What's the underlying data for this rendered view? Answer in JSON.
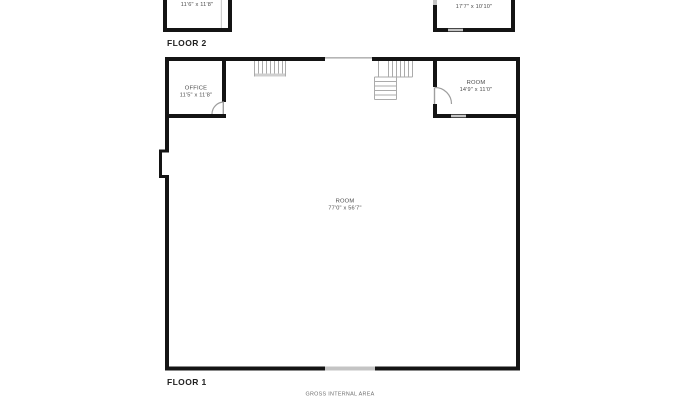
{
  "colors": {
    "background": "#ffffff",
    "wall": "#141414",
    "stair_line": "#ababab",
    "door_arc": "#9e9e9e",
    "window_fill": "#c4c4c4",
    "floor_label_text": "#1f1f1f",
    "dimension_text": "#4a4a4a",
    "footer_text": "#6f6f6f"
  },
  "floor2": {
    "label": "FLOOR 2",
    "left_room": {
      "dims": "11'6\" x 11'8\""
    },
    "right_room": {
      "dims": "17'7\" x 10'10\""
    }
  },
  "floor1": {
    "label": "FLOOR 1",
    "office": {
      "name": "OFFICE",
      "dims": "11'5\" x 11'8\""
    },
    "right_room": {
      "name": "ROOM",
      "dims": "14'9\" x 11'0\""
    },
    "main_room": {
      "name": "ROOM",
      "dims": "77'0\" x 56'7\""
    }
  },
  "footer": {
    "gross_internal_area": "GROSS INTERNAL AREA"
  }
}
